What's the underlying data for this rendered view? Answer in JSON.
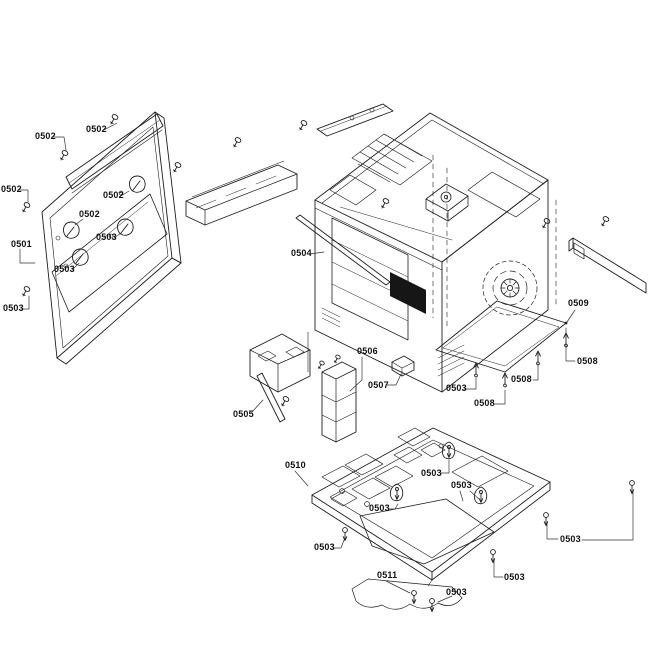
{
  "diagram": {
    "kind": "exploded-parts-diagram",
    "background_color": "#ffffff",
    "line_color": "#1e1e1e",
    "label_color": "#111111",
    "labels": [
      {
        "text": "0502",
        "x": 35,
        "y": 132
      },
      {
        "text": "0502",
        "x": 86,
        "y": 125
      },
      {
        "text": "0502",
        "x": 1,
        "y": 185
      },
      {
        "text": "0502",
        "x": 103,
        "y": 191
      },
      {
        "text": "0502",
        "x": 79,
        "y": 210
      },
      {
        "text": "0501",
        "x": 11,
        "y": 240
      },
      {
        "text": "0503",
        "x": 96,
        "y": 233
      },
      {
        "text": "0503",
        "x": 54,
        "y": 265
      },
      {
        "text": "0503",
        "x": 3,
        "y": 304
      },
      {
        "text": "0504",
        "x": 291,
        "y": 249
      },
      {
        "text": "0509",
        "x": 568,
        "y": 299
      },
      {
        "text": "0508",
        "x": 577,
        "y": 357
      },
      {
        "text": "0508",
        "x": 511,
        "y": 375
      },
      {
        "text": "0508",
        "x": 474,
        "y": 399
      },
      {
        "text": "0503",
        "x": 446,
        "y": 384
      },
      {
        "text": "0506",
        "x": 357,
        "y": 347
      },
      {
        "text": "0507",
        "x": 368,
        "y": 381
      },
      {
        "text": "0505",
        "x": 233,
        "y": 410
      },
      {
        "text": "0510",
        "x": 285,
        "y": 461
      },
      {
        "text": "0503",
        "x": 421,
        "y": 469
      },
      {
        "text": "0503",
        "x": 451,
        "y": 481
      },
      {
        "text": "0503",
        "x": 369,
        "y": 504
      },
      {
        "text": "0503",
        "x": 314,
        "y": 543
      },
      {
        "text": "0503",
        "x": 560,
        "y": 535
      },
      {
        "text": "0503",
        "x": 504,
        "y": 573
      },
      {
        "text": "0511",
        "x": 377,
        "y": 571
      },
      {
        "text": "0503",
        "x": 446,
        "y": 588
      }
    ]
  }
}
